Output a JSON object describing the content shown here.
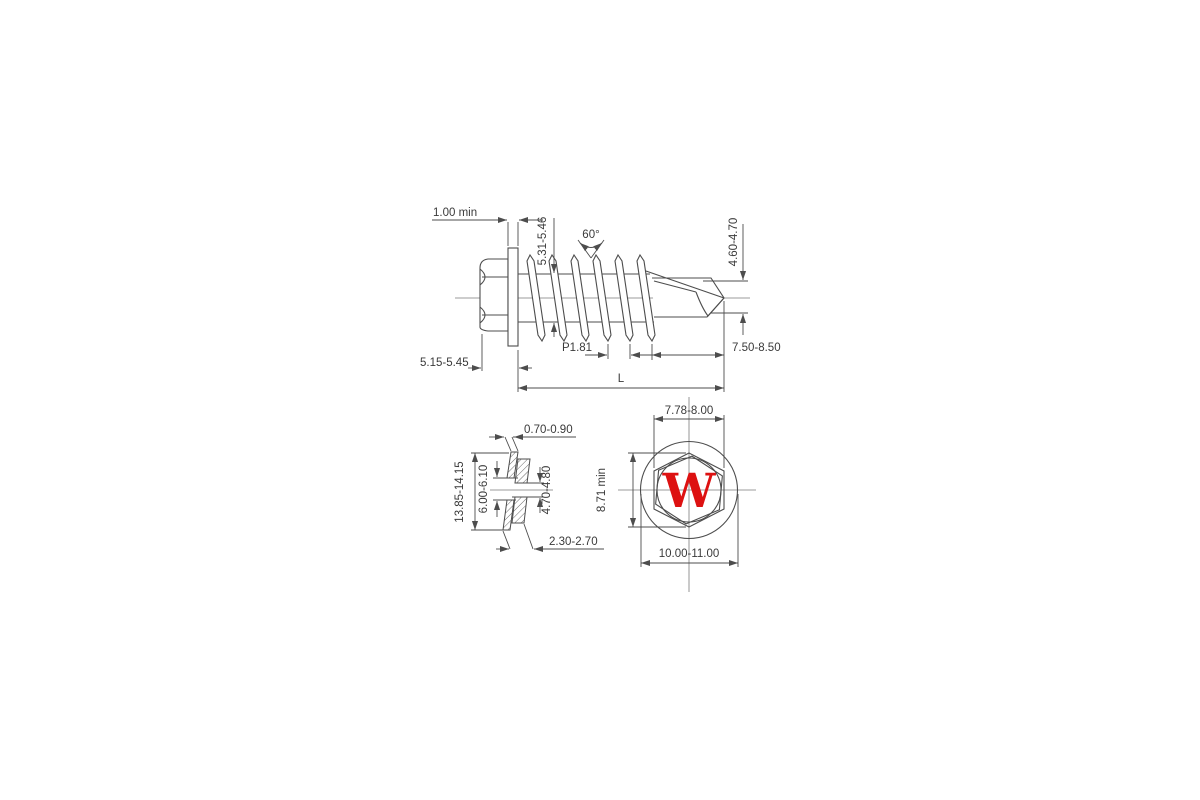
{
  "page": {
    "background": "#ffffff"
  },
  "drawing": {
    "stroke_color": "#4d4d4d",
    "logo": {
      "letter": "W",
      "color": "#dd1111"
    },
    "side_view": {
      "flange_thickness": "1.00 min",
      "thread_diameter": "5.31-5.46",
      "thread_angle": "60°",
      "point_diameter": "4.60-4.70",
      "head_height": "5.15-5.45",
      "thread_pitch": "P1.81",
      "point_length": "7.50-8.50",
      "length": "L"
    },
    "washer_view": {
      "plate_thickness": "0.70-0.90",
      "outer_diameter": "13.85-14.15",
      "plate_hole_diameter": "6.00-6.10",
      "seal_hole_diameter": "4.70-4.80",
      "seal_thickness": "2.30-2.70"
    },
    "head_view": {
      "width_across_flats": "7.78-8.00",
      "width_across_corners": "8.71 min",
      "washer_outer_diameter": "10.00-11.00",
      "logo_letter": "W"
    }
  }
}
